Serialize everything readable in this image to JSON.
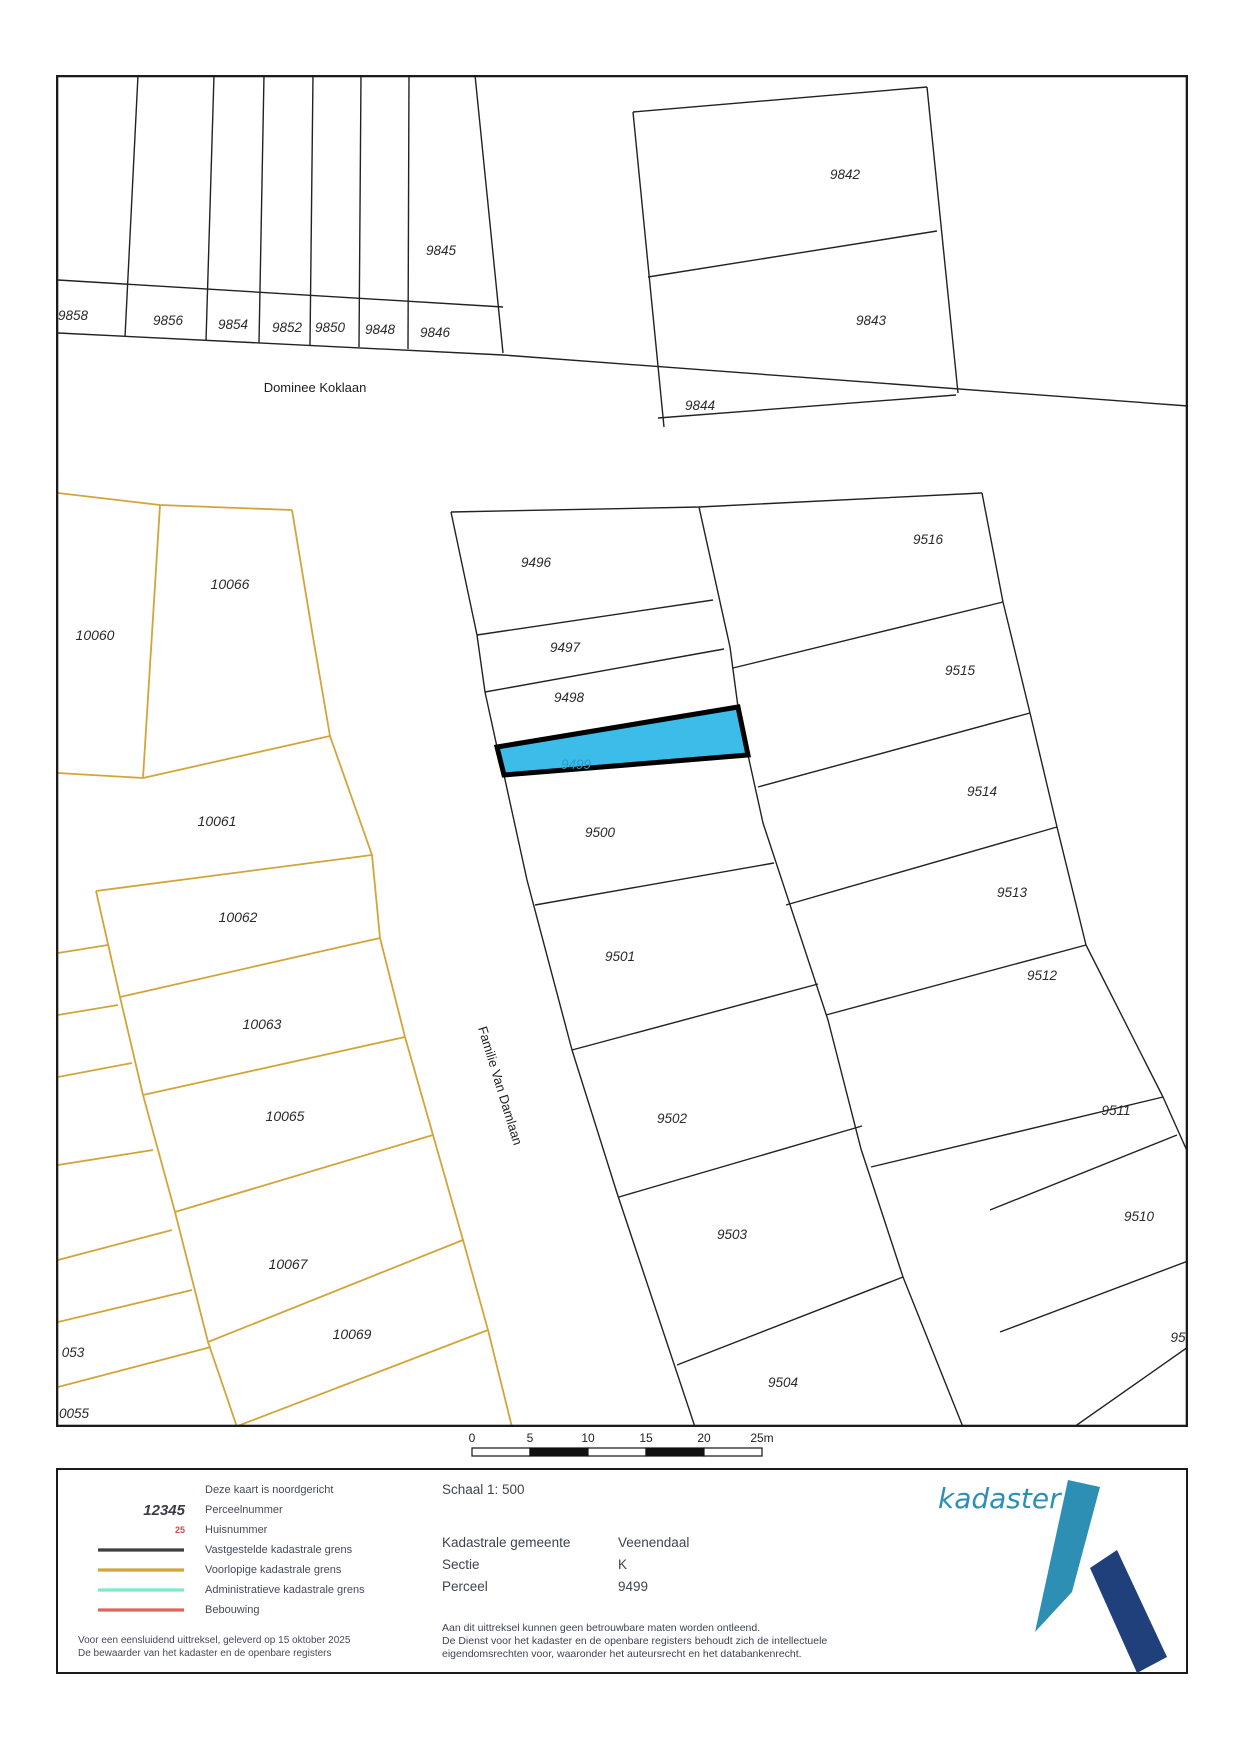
{
  "map": {
    "highlight_color": "#3bbce9",
    "streets": {
      "koklaan": "Dominee Koklaan",
      "damlaan": "Familie Van Damlaan"
    },
    "parcels": {
      "9842": "9842",
      "9843": "9843",
      "9844": "9844",
      "9845": "9845",
      "9846": "9846",
      "9848": "9848",
      "9850": "9850",
      "9852": "9852",
      "9854": "9854",
      "9856": "9856",
      "9858": "9858",
      "9496": "9496",
      "9497": "9497",
      "9498": "9498",
      "9499": "9499",
      "9500": "9500",
      "9501": "9501",
      "9502": "9502",
      "9503": "9503",
      "9504": "9504",
      "9510": "9510",
      "9511": "9511",
      "9512": "9512",
      "9513": "9513",
      "9514": "9514",
      "9515": "9515",
      "9516": "9516",
      "95partial": "95",
      "10060": "10060",
      "10061": "10061",
      "10062": "10062",
      "10063": "10063",
      "10065": "10065",
      "10066": "10066",
      "10067": "10067",
      "10069": "10069",
      "053": "053",
      "0055": "0055"
    }
  },
  "scalebar": {
    "ticks": [
      "0",
      "5",
      "10",
      "15",
      "20",
      "25m"
    ]
  },
  "footer": {
    "legend": {
      "north_note": "Deze kaart is noordgericht",
      "parcel_number_sample": "12345",
      "parcel_number_label": "Perceelnummer",
      "house_number_sample": "25",
      "house_number_label": "Huisnummer",
      "lines": [
        {
          "label": "Vastgestelde kadastrale grens",
          "color": "#3f3f3f"
        },
        {
          "label": "Voorlopige kadastrale grens",
          "color": "#d2a53a"
        },
        {
          "label": "Administratieve kadastrale grens",
          "color": "#7de9cb"
        },
        {
          "label": "Bebouwing",
          "color": "#e2635c"
        }
      ],
      "footnote1": "Voor een eensluidend uittreksel, geleverd op 15 oktober 2025",
      "footnote2": "De bewaarder van het kadaster en de openbare registers"
    },
    "details": {
      "schaal_label": "Schaal 1: 500",
      "rows": [
        {
          "label": "Kadastrale gemeente",
          "value": "Veenendaal"
        },
        {
          "label": "Sectie",
          "value": "K"
        },
        {
          "label": "Perceel",
          "value": "9499"
        }
      ],
      "disclaimer": [
        "Aan dit uittreksel kunnen geen betrouwbare maten worden ontleend.",
        "De Dienst voor het kadaster en de openbare registers behoudt zich de intellectuele",
        "eigendomsrechten voor, waaronder het auteursrecht en het databankenrecht."
      ]
    },
    "logo": {
      "text": "kadaster",
      "teal": "#2e8fb5",
      "navy": "#20407c"
    }
  }
}
